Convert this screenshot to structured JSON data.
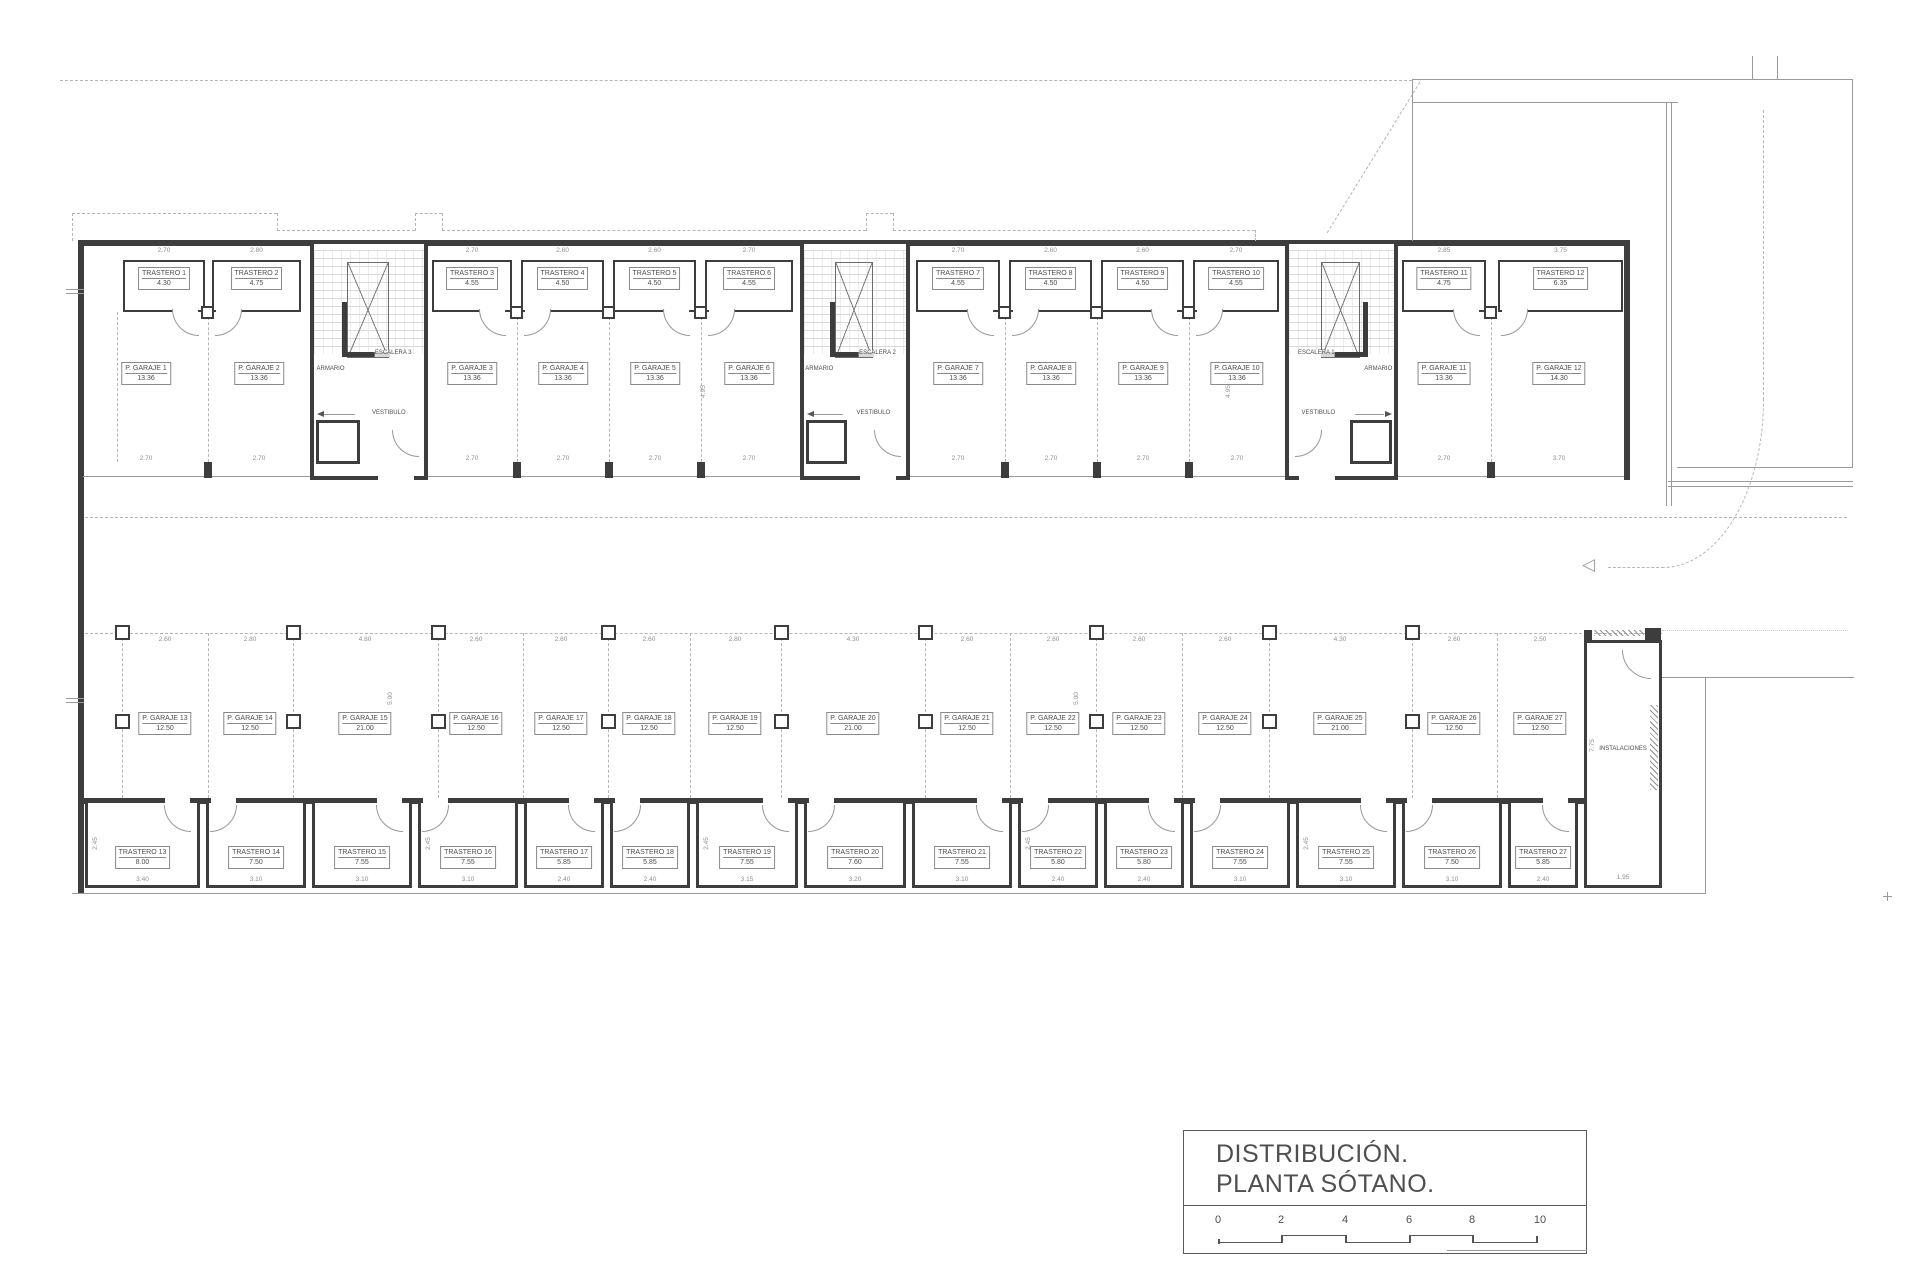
{
  "title_block": {
    "line1": "DISTRIBUCIÓN.",
    "line2": "PLANTA SÓTANO.",
    "ticks": [
      "0",
      "2",
      "4",
      "6",
      "8",
      "10"
    ]
  },
  "plan": {
    "upper_trasteros": [
      {
        "name": "TRASTERO 1",
        "area": "4.30",
        "dim": "2.70",
        "x": 123,
        "w": 82,
        "door": "r"
      },
      {
        "name": "TRASTERO 2",
        "area": "4.75",
        "dim": "2.80",
        "x": 212,
        "w": 89,
        "door": "l"
      },
      {
        "name": "TRASTERO 3",
        "area": "4.55",
        "dim": "2.70",
        "x": 432,
        "w": 80,
        "door": "r"
      },
      {
        "name": "TRASTERO 4",
        "area": "4.50",
        "dim": "2.60",
        "x": 521,
        "w": 83,
        "door": "l"
      },
      {
        "name": "TRASTERO 5",
        "area": "4.50",
        "dim": "2.60",
        "x": 613,
        "w": 83,
        "door": "r"
      },
      {
        "name": "TRASTERO 6",
        "area": "4.55",
        "dim": "2.70",
        "x": 705,
        "w": 88,
        "door": "l"
      },
      {
        "name": "TRASTERO 7",
        "area": "4.55",
        "dim": "2.70",
        "x": 916,
        "w": 84,
        "door": "r"
      },
      {
        "name": "TRASTERO 8",
        "area": "4.50",
        "dim": "2.60",
        "x": 1009,
        "w": 83,
        "door": "l"
      },
      {
        "name": "TRASTERO 9",
        "area": "4.50",
        "dim": "2.60",
        "x": 1101,
        "w": 83,
        "door": "r"
      },
      {
        "name": "TRASTERO 10",
        "area": "4.55",
        "dim": "2.70",
        "x": 1193,
        "w": 86,
        "door": "l"
      },
      {
        "name": "TRASTERO 11",
        "area": "4.75",
        "dim": "2.85",
        "x": 1402,
        "w": 84,
        "door": "r"
      },
      {
        "name": "TRASTERO 12",
        "area": "6.35",
        "dim": "3.75",
        "x": 1498,
        "w": 125,
        "door": "l"
      }
    ],
    "upper_garajes": [
      {
        "name": "P. GARAJE 1",
        "area": "13.36",
        "dim": "2.70",
        "cx": 146
      },
      {
        "name": "P. GARAJE 2",
        "area": "13.36",
        "dim": "2.70",
        "cx": 259
      },
      {
        "name": "P. GARAJE 3",
        "area": "13.36",
        "dim": "2.70",
        "cx": 472
      },
      {
        "name": "P. GARAJE 4",
        "area": "13.36",
        "dim": "2.70",
        "cx": 563
      },
      {
        "name": "P. GARAJE 5",
        "area": "13.36",
        "dim": "2.70",
        "cx": 655
      },
      {
        "name": "P. GARAJE 6",
        "area": "13.36",
        "dim": "2.70",
        "cx": 749
      },
      {
        "name": "P. GARAJE 7",
        "area": "13.36",
        "dim": "2.70",
        "cx": 958
      },
      {
        "name": "P. GARAJE 8",
        "area": "13.36",
        "dim": "2.70",
        "cx": 1051
      },
      {
        "name": "P. GARAJE 9",
        "area": "13.36",
        "dim": "2.70",
        "cx": 1143
      },
      {
        "name": "P. GARAJE 10",
        "area": "13.36",
        "dim": "2.70",
        "cx": 1237
      },
      {
        "name": "P. GARAJE 11",
        "area": "13.36",
        "dim": "2.70",
        "cx": 1444
      },
      {
        "name": "P. GARAJE 12",
        "area": "14.30",
        "dim": "3.70",
        "cx": 1559
      }
    ],
    "cores": [
      {
        "label": "ESCALERA 3",
        "armario": "ARMARIO",
        "vestibulo": "VESTIBULO",
        "x": 310,
        "w": 118,
        "mirror": false
      },
      {
        "label": "ESCALERA 2",
        "armario": "ARMARIO",
        "vestibulo": "VESTIBULO",
        "x": 800,
        "w": 110,
        "mirror": false
      },
      {
        "label": "ESCALERA 1",
        "armario": "ARMARIO",
        "vestibulo": "VESTIBULO",
        "x": 1285,
        "w": 113,
        "mirror": true
      }
    ],
    "lower_garajes": [
      {
        "name": "P. GARAJE 13",
        "area": "12.50",
        "dim": "2.60",
        "cx": 165
      },
      {
        "name": "P. GARAJE 14",
        "area": "12.50",
        "dim": "2.80",
        "cx": 250
      },
      {
        "name": "P. GARAJE 15",
        "area": "21.00",
        "dim": "4.80",
        "cx": 365
      },
      {
        "name": "P. GARAJE 16",
        "area": "12.50",
        "dim": "2.60",
        "cx": 476
      },
      {
        "name": "P. GARAJE 17",
        "area": "12.50",
        "dim": "2.60",
        "cx": 561
      },
      {
        "name": "P. GARAJE 18",
        "area": "12.50",
        "dim": "2.60",
        "cx": 649
      },
      {
        "name": "P. GARAJE 19",
        "area": "12.50",
        "dim": "2.80",
        "cx": 735
      },
      {
        "name": "P. GARAJE 20",
        "area": "21.00",
        "dim": "4.30",
        "cx": 853
      },
      {
        "name": "P. GARAJE 21",
        "area": "12.50",
        "dim": "2.60",
        "cx": 967
      },
      {
        "name": "P. GARAJE 22",
        "area": "12.50",
        "dim": "2.60",
        "cx": 1053
      },
      {
        "name": "P. GARAJE 23",
        "area": "12.50",
        "dim": "2.60",
        "cx": 1139
      },
      {
        "name": "P. GARAJE 24",
        "area": "12.50",
        "dim": "2.60",
        "cx": 1225
      },
      {
        "name": "P. GARAJE 25",
        "area": "21.00",
        "dim": "4.30",
        "cx": 1340
      },
      {
        "name": "P. GARAJE 26",
        "area": "12.50",
        "dim": "2.60",
        "cx": 1454
      },
      {
        "name": "P. GARAJE 27",
        "area": "12.50",
        "dim": "2.50",
        "cx": 1540
      }
    ],
    "lower_trasteros": [
      {
        "name": "TRASTERO 13",
        "area": "8.00",
        "dim": "3.40",
        "x": 85,
        "w": 115,
        "door": "r"
      },
      {
        "name": "TRASTERO 14",
        "area": "7.50",
        "dim": "3.10",
        "x": 206,
        "w": 100,
        "door": "l"
      },
      {
        "name": "TRASTERO 15",
        "area": "7.55",
        "dim": "3.10",
        "x": 312,
        "w": 100,
        "door": "r"
      },
      {
        "name": "TRASTERO 16",
        "area": "7.55",
        "dim": "3.10",
        "x": 418,
        "w": 100,
        "door": "l"
      },
      {
        "name": "TRASTERO 17",
        "area": "5.85",
        "dim": "2.40",
        "x": 524,
        "w": 80,
        "door": "r"
      },
      {
        "name": "TRASTERO 18",
        "area": "5.85",
        "dim": "2.40",
        "x": 610,
        "w": 80,
        "door": "l"
      },
      {
        "name": "TRASTERO 19",
        "area": "7.55",
        "dim": "3.15",
        "x": 696,
        "w": 102,
        "door": "r"
      },
      {
        "name": "TRASTERO 20",
        "area": "7.60",
        "dim": "3.20",
        "x": 804,
        "w": 102,
        "door": "l"
      },
      {
        "name": "TRASTERO 21",
        "area": "7.55",
        "dim": "3.10",
        "x": 912,
        "w": 100,
        "door": "r"
      },
      {
        "name": "TRASTERO 22",
        "area": "5.80",
        "dim": "2.40",
        "x": 1018,
        "w": 80,
        "door": "l"
      },
      {
        "name": "TRASTERO 23",
        "area": "5.80",
        "dim": "2.40",
        "x": 1104,
        "w": 80,
        "door": "r"
      },
      {
        "name": "TRASTERO 24",
        "area": "7.55",
        "dim": "3.10",
        "x": 1190,
        "w": 100,
        "door": "l"
      },
      {
        "name": "TRASTERO 25",
        "area": "7.55",
        "dim": "3.10",
        "x": 1296,
        "w": 100,
        "door": "r"
      },
      {
        "name": "TRASTERO 26",
        "area": "7.50",
        "dim": "3.10",
        "x": 1402,
        "w": 100,
        "door": "l"
      },
      {
        "name": "TRASTERO 27",
        "area": "5.85",
        "dim": "2.40",
        "x": 1508,
        "w": 70,
        "door": "r"
      }
    ],
    "instalaciones": {
      "label": "INSTALACIONES",
      "height_dim": "7.75",
      "dim": "1.95"
    },
    "side_dims": {
      "upper": "4.95",
      "lower": "5.00",
      "storeroom": "2.45"
    }
  }
}
